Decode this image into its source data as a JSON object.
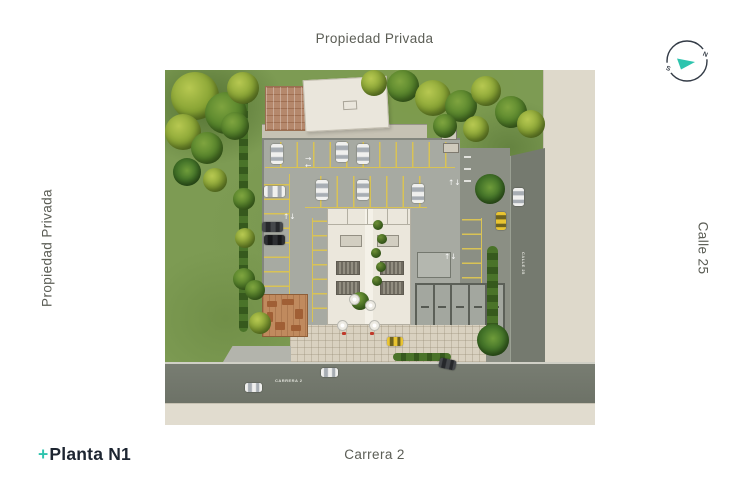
{
  "labels": {
    "top": "Propiedad Privada",
    "left": "Propiedad Privada",
    "right": "Calle 25",
    "bottom": "Carrera 2"
  },
  "logo": {
    "plus": "+",
    "name": "Planta N1"
  },
  "compass": {
    "north": "N",
    "south": "S"
  },
  "plan": {
    "street_labels": {
      "carrera_2": "CARRERA 2",
      "calle_25": "CALLE 25"
    }
  },
  "colors": {
    "accent_teal": "#2ec4ae",
    "label_text": "#5b5d55",
    "logo_text": "#1d2531",
    "lawn": "#7d9b53",
    "road": "#72776c",
    "sidewalk": "#ded9cb",
    "parking": "#a7aaa2",
    "stall_yellow": "#d9c355",
    "roof_light": "#eae6dc",
    "roof_brick": "#b5886c",
    "lobby_wood": "#c08a5e",
    "plaza_paver": "#d9d1c0",
    "taxi_yellow": "#e9c431"
  }
}
